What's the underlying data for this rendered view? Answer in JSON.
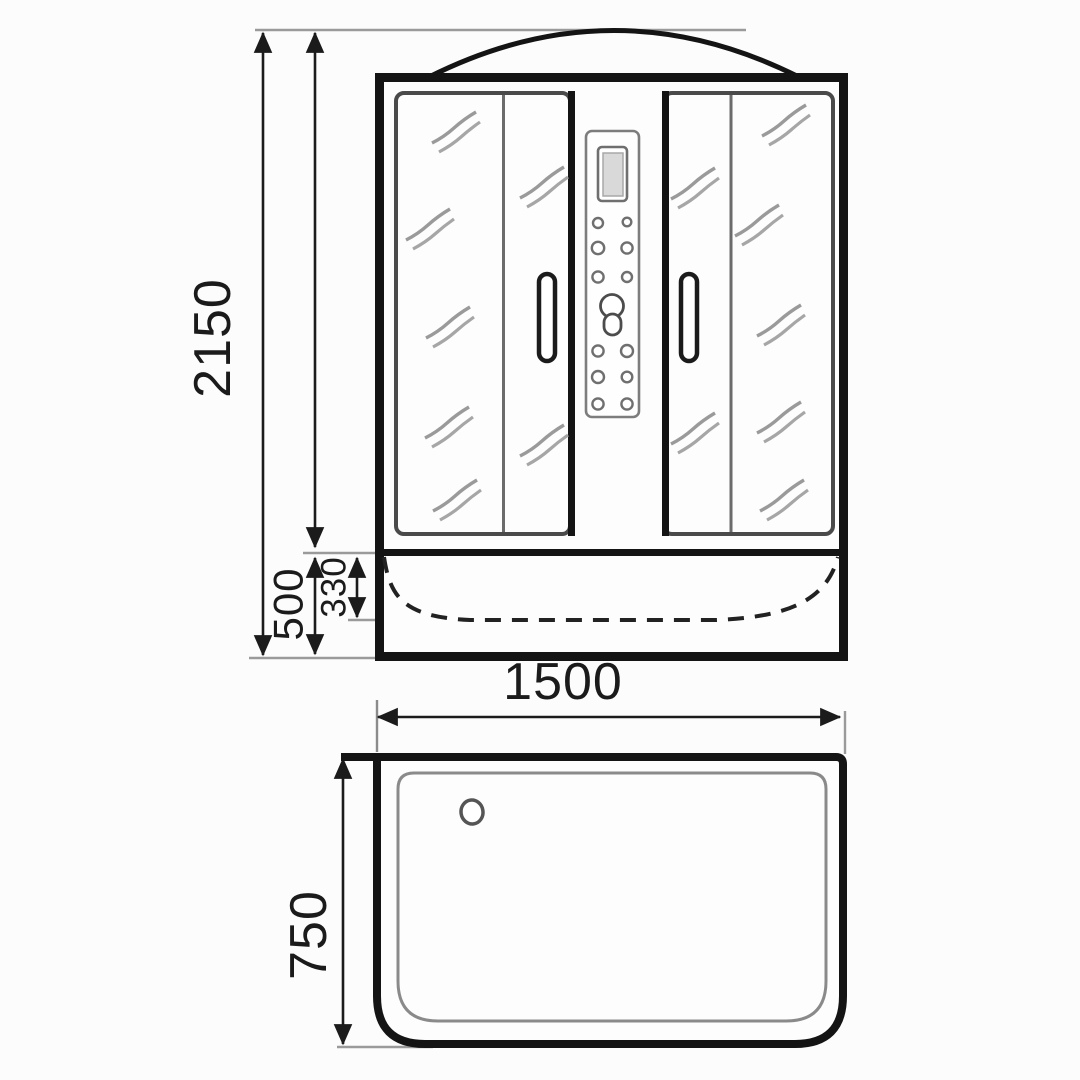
{
  "title": "Shower cabin dimensional drawing",
  "front_view": {
    "name": "front elevation",
    "total_height_mm": "2150",
    "tray_height_mm": "500",
    "tray_inner_depth_mm": "330"
  },
  "plan_view": {
    "name": "tray plan view",
    "width_mm": "1500",
    "depth_mm": "750"
  },
  "colors": {
    "line": "#1b1b1b",
    "frame": "#141414",
    "extension_line": "#9a9a9a",
    "glass_border": "#4a4a4a",
    "glass_shine": "#9a9a9a",
    "panel_border": "#7d7d7d",
    "display_fill": "#d9d9d9"
  }
}
